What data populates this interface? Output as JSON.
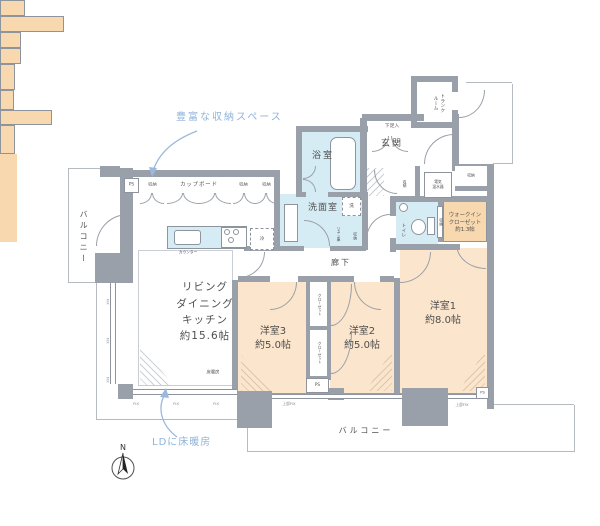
{
  "title": "マンション間取り図",
  "annotations": {
    "storage_note": "豊富な収納スペース",
    "heating_note": "LDに床暖房",
    "north": "N"
  },
  "labels": {
    "trunk": "トランク\nルーム",
    "balcony": "バルコニー",
    "genkan": "玄関",
    "shoe": "下足入",
    "bath": "浴室",
    "washroom": "洗面室",
    "wash": "洗",
    "fridge": "冷",
    "toilet": "トイレ",
    "linen": "リネン庫",
    "hall": "廊下",
    "cupboard": "カップボード",
    "counter": "カウンター",
    "storage": "収納",
    "heater": "電気\n温水器",
    "wic": "ウォークイン\nクローゼット\n約1.3帖",
    "ldk": "リビング\nダイニング\nキッチン\n約15.6帖",
    "room1": "洋室1\n約8.0帖",
    "room2": "洋室2\n約5.0帖",
    "room3": "洋室3\n約5.0帖",
    "closet": "クローゼット",
    "floor_heating": "床暖房",
    "ps": "PS",
    "fix": "FIX",
    "upper_fix": "上部FIX"
  },
  "colors": {
    "wall": "#9aa0a9",
    "wet_area": "#d6ecf5",
    "room": "#fbe5cc",
    "storage": "#f8d8ae",
    "annotation": "#8fb3da"
  }
}
